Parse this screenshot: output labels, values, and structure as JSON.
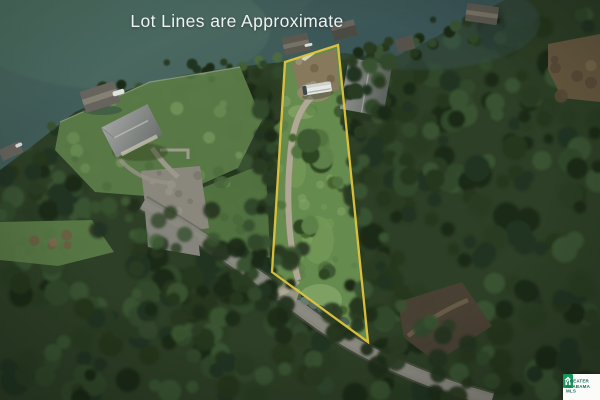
{
  "overlay": {
    "title": "Lot Lines are Approximate"
  },
  "watermark": {
    "line1": "GREATER",
    "line2": "ALABAMA",
    "line3": "MLS",
    "tile_color": "#149a57",
    "text_color": "#1d6a5e"
  },
  "scene": {
    "lot_line_color": "#e9cb3d",
    "water_color": "#44605c",
    "forest_color": "#2e4026",
    "lot_grass_color": "#6a8f50",
    "road_color": "#8b8981",
    "gravel_color": "#b5ad99"
  }
}
